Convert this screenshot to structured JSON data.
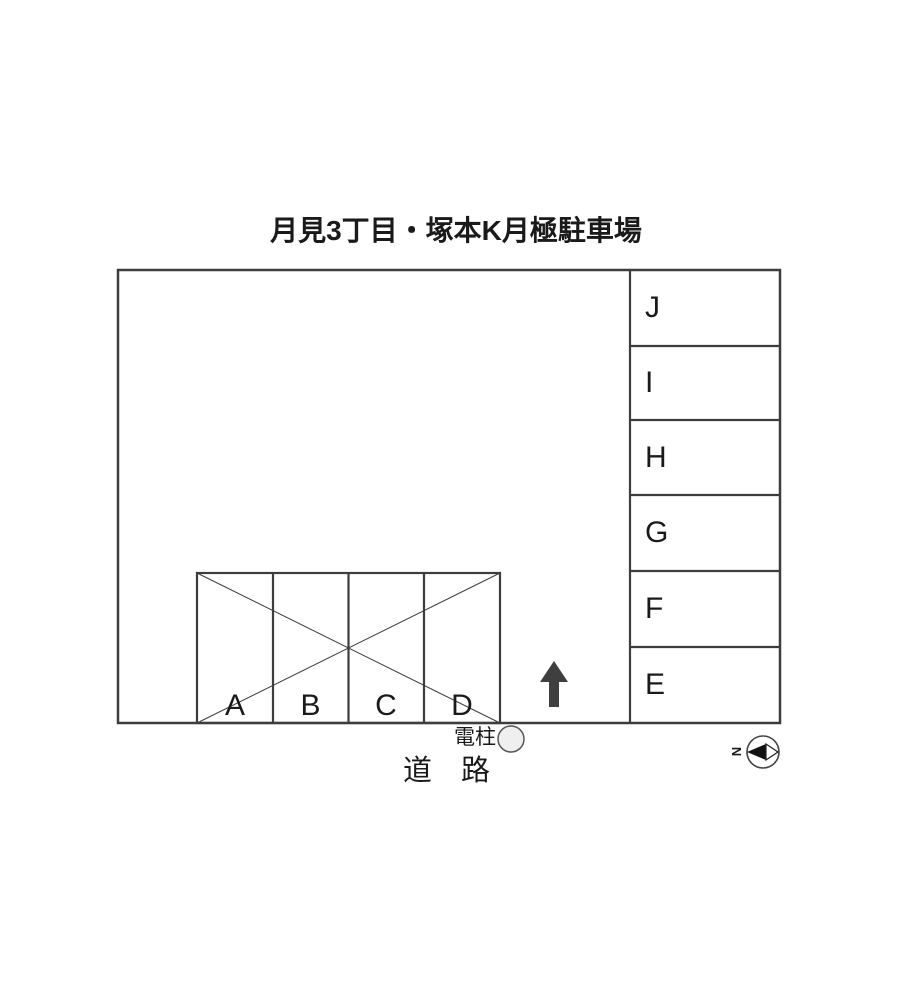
{
  "title": "月見3丁目・塚本K月極駐車場",
  "parking": {
    "right_spaces": [
      "J",
      "I",
      "H",
      "G",
      "F",
      "E"
    ],
    "bottom_spaces": [
      "A",
      "B",
      "C",
      "D"
    ]
  },
  "labels": {
    "utility_pole": "電柱",
    "road": "道　路",
    "compass_north": "N"
  },
  "icons": {
    "up_arrow": "up-arrow",
    "compass": "compass-needle-pointing-left",
    "utility_pole_marker": "circle"
  },
  "colors": {
    "line": "#3d3d3d",
    "arrow": "#3f3f3f",
    "text": "#1a1a1a",
    "pole_fill": "#efefef",
    "background": "#ffffff"
  }
}
